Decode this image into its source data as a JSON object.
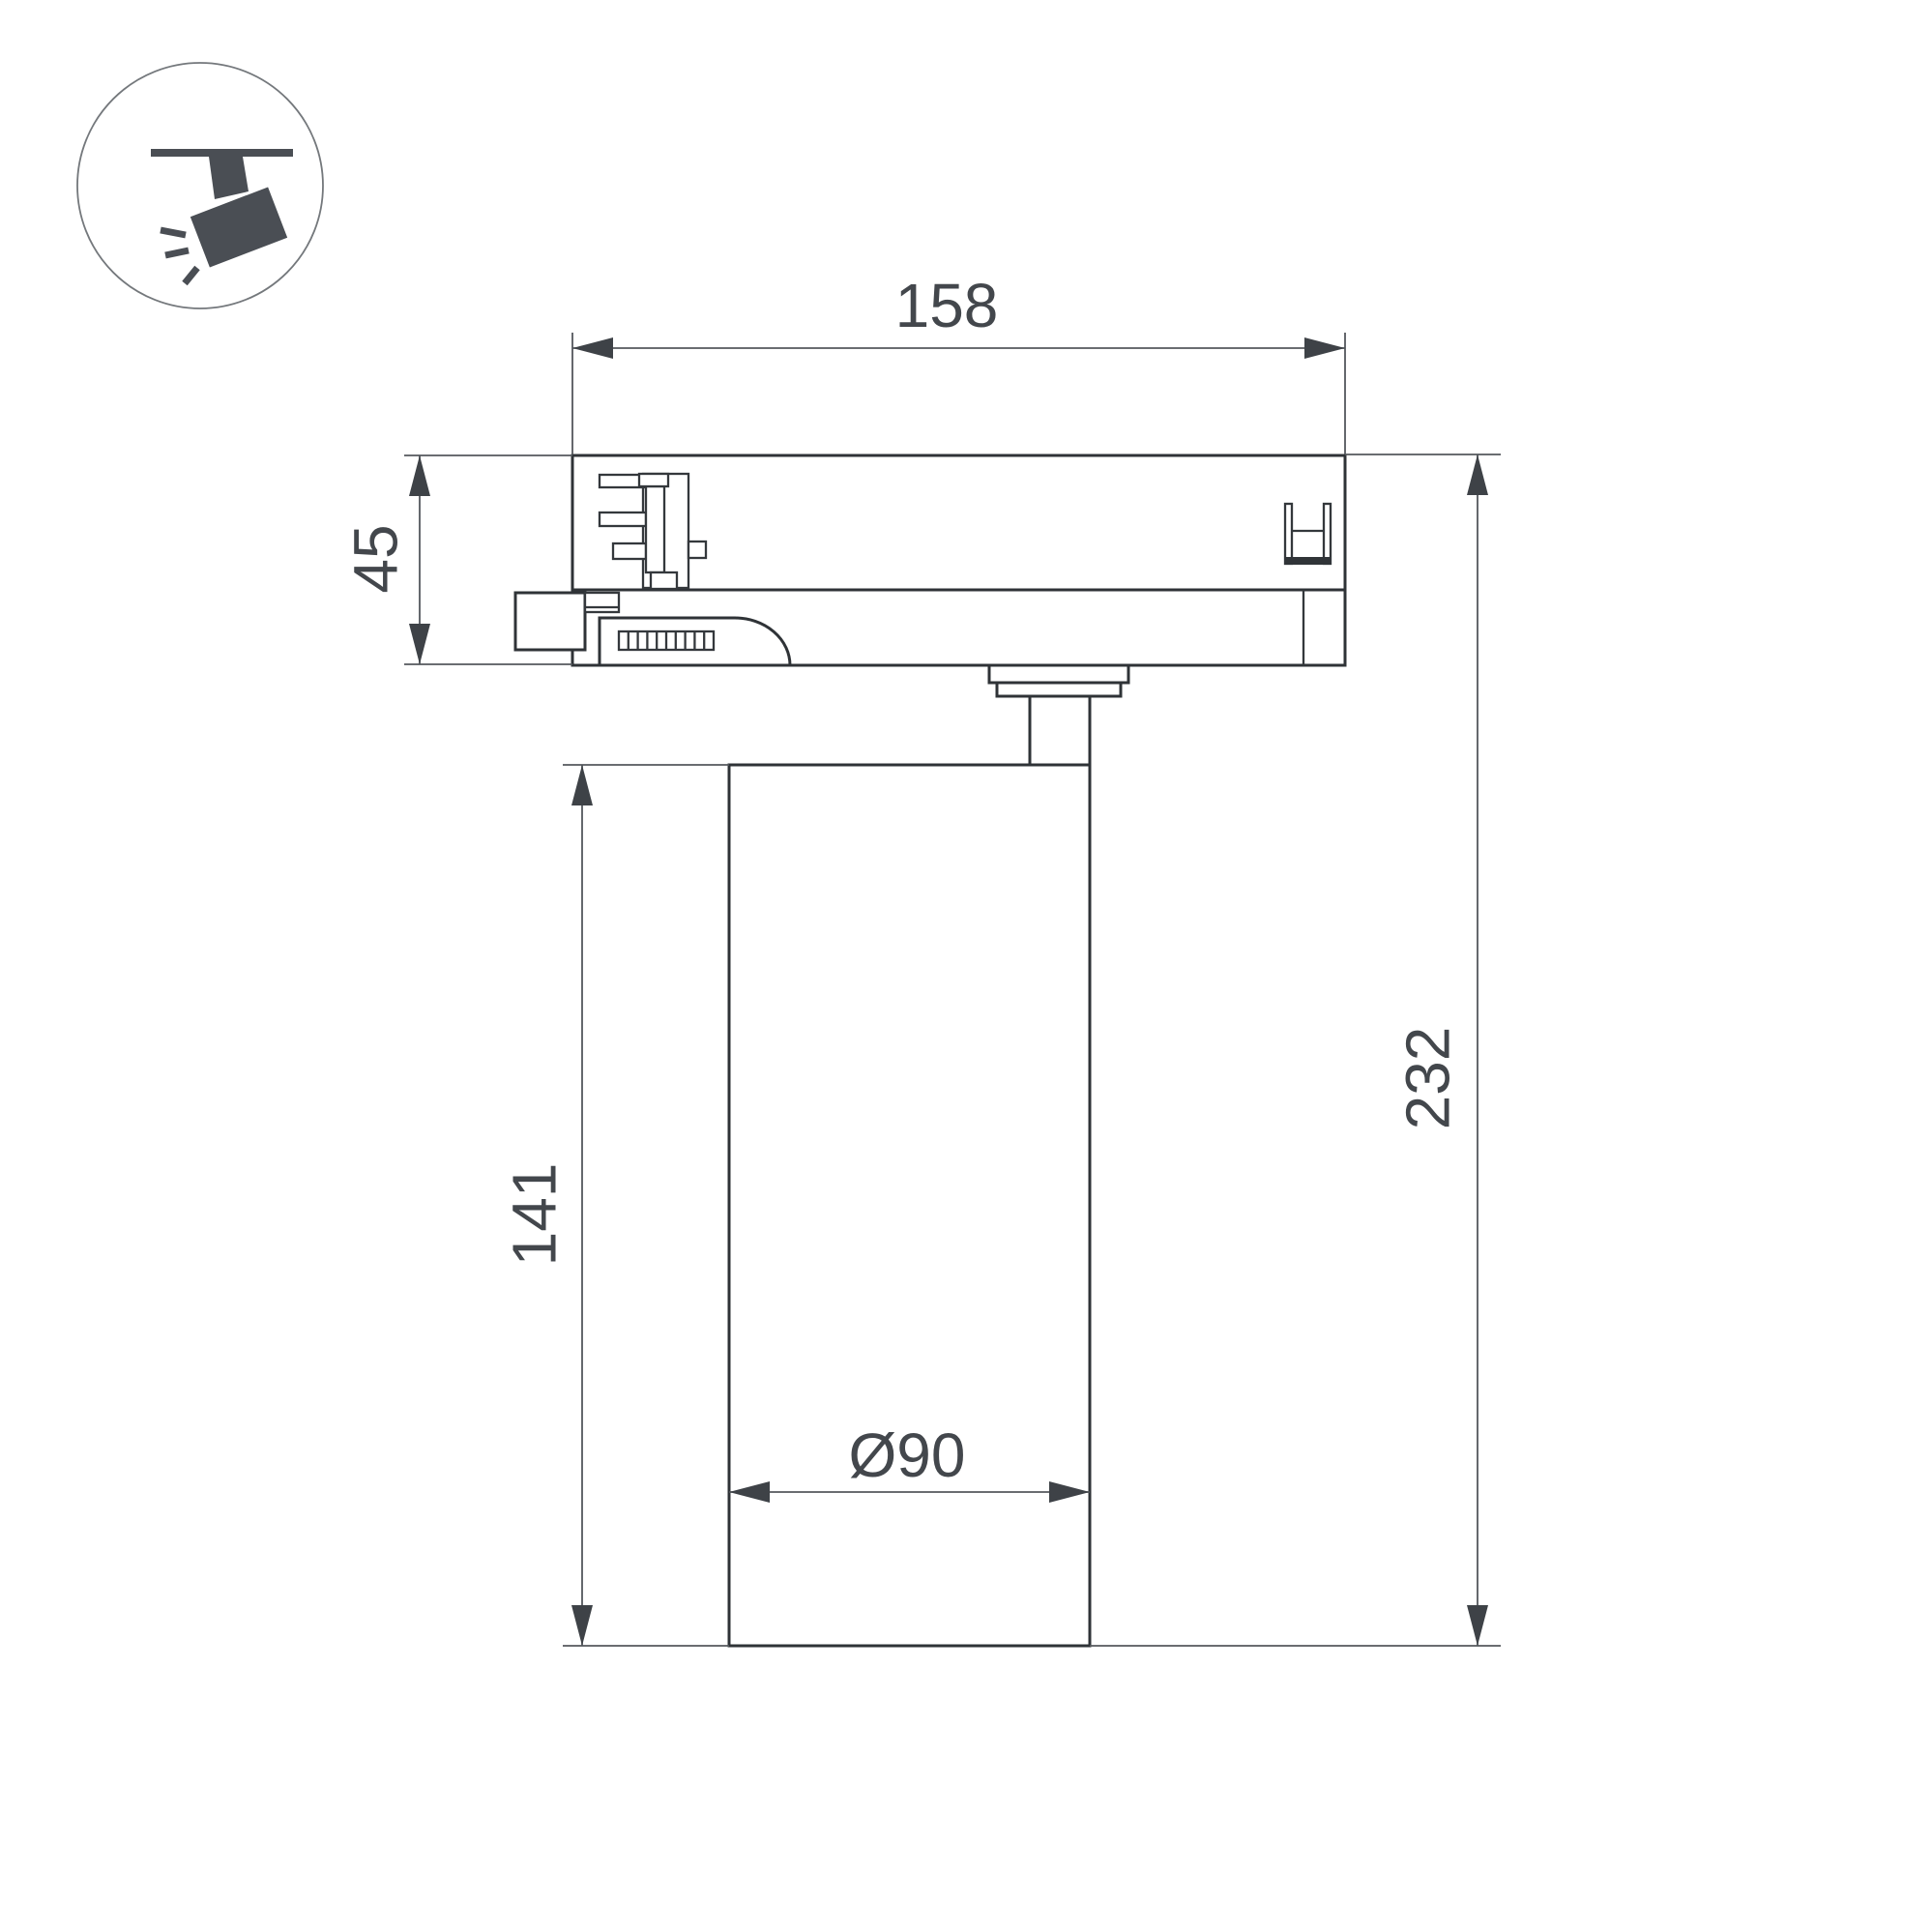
{
  "meta": {
    "background": "#ffffff"
  },
  "colors": {
    "outline": "#2f3337",
    "detail": "#34383c",
    "dimension_line": "#54585d",
    "dimension_text": "#43474c",
    "arrow": "#3e4247",
    "icon_glyph": "#4a4e54",
    "icon_circle_stroke": "#74787c"
  },
  "icon": {
    "name": "track-spotlight-icon"
  },
  "dimensions": {
    "track_adapter_width": "158",
    "track_adapter_height": "45",
    "body_height": "141",
    "total_height": "232",
    "body_diameter": "Ø90"
  }
}
